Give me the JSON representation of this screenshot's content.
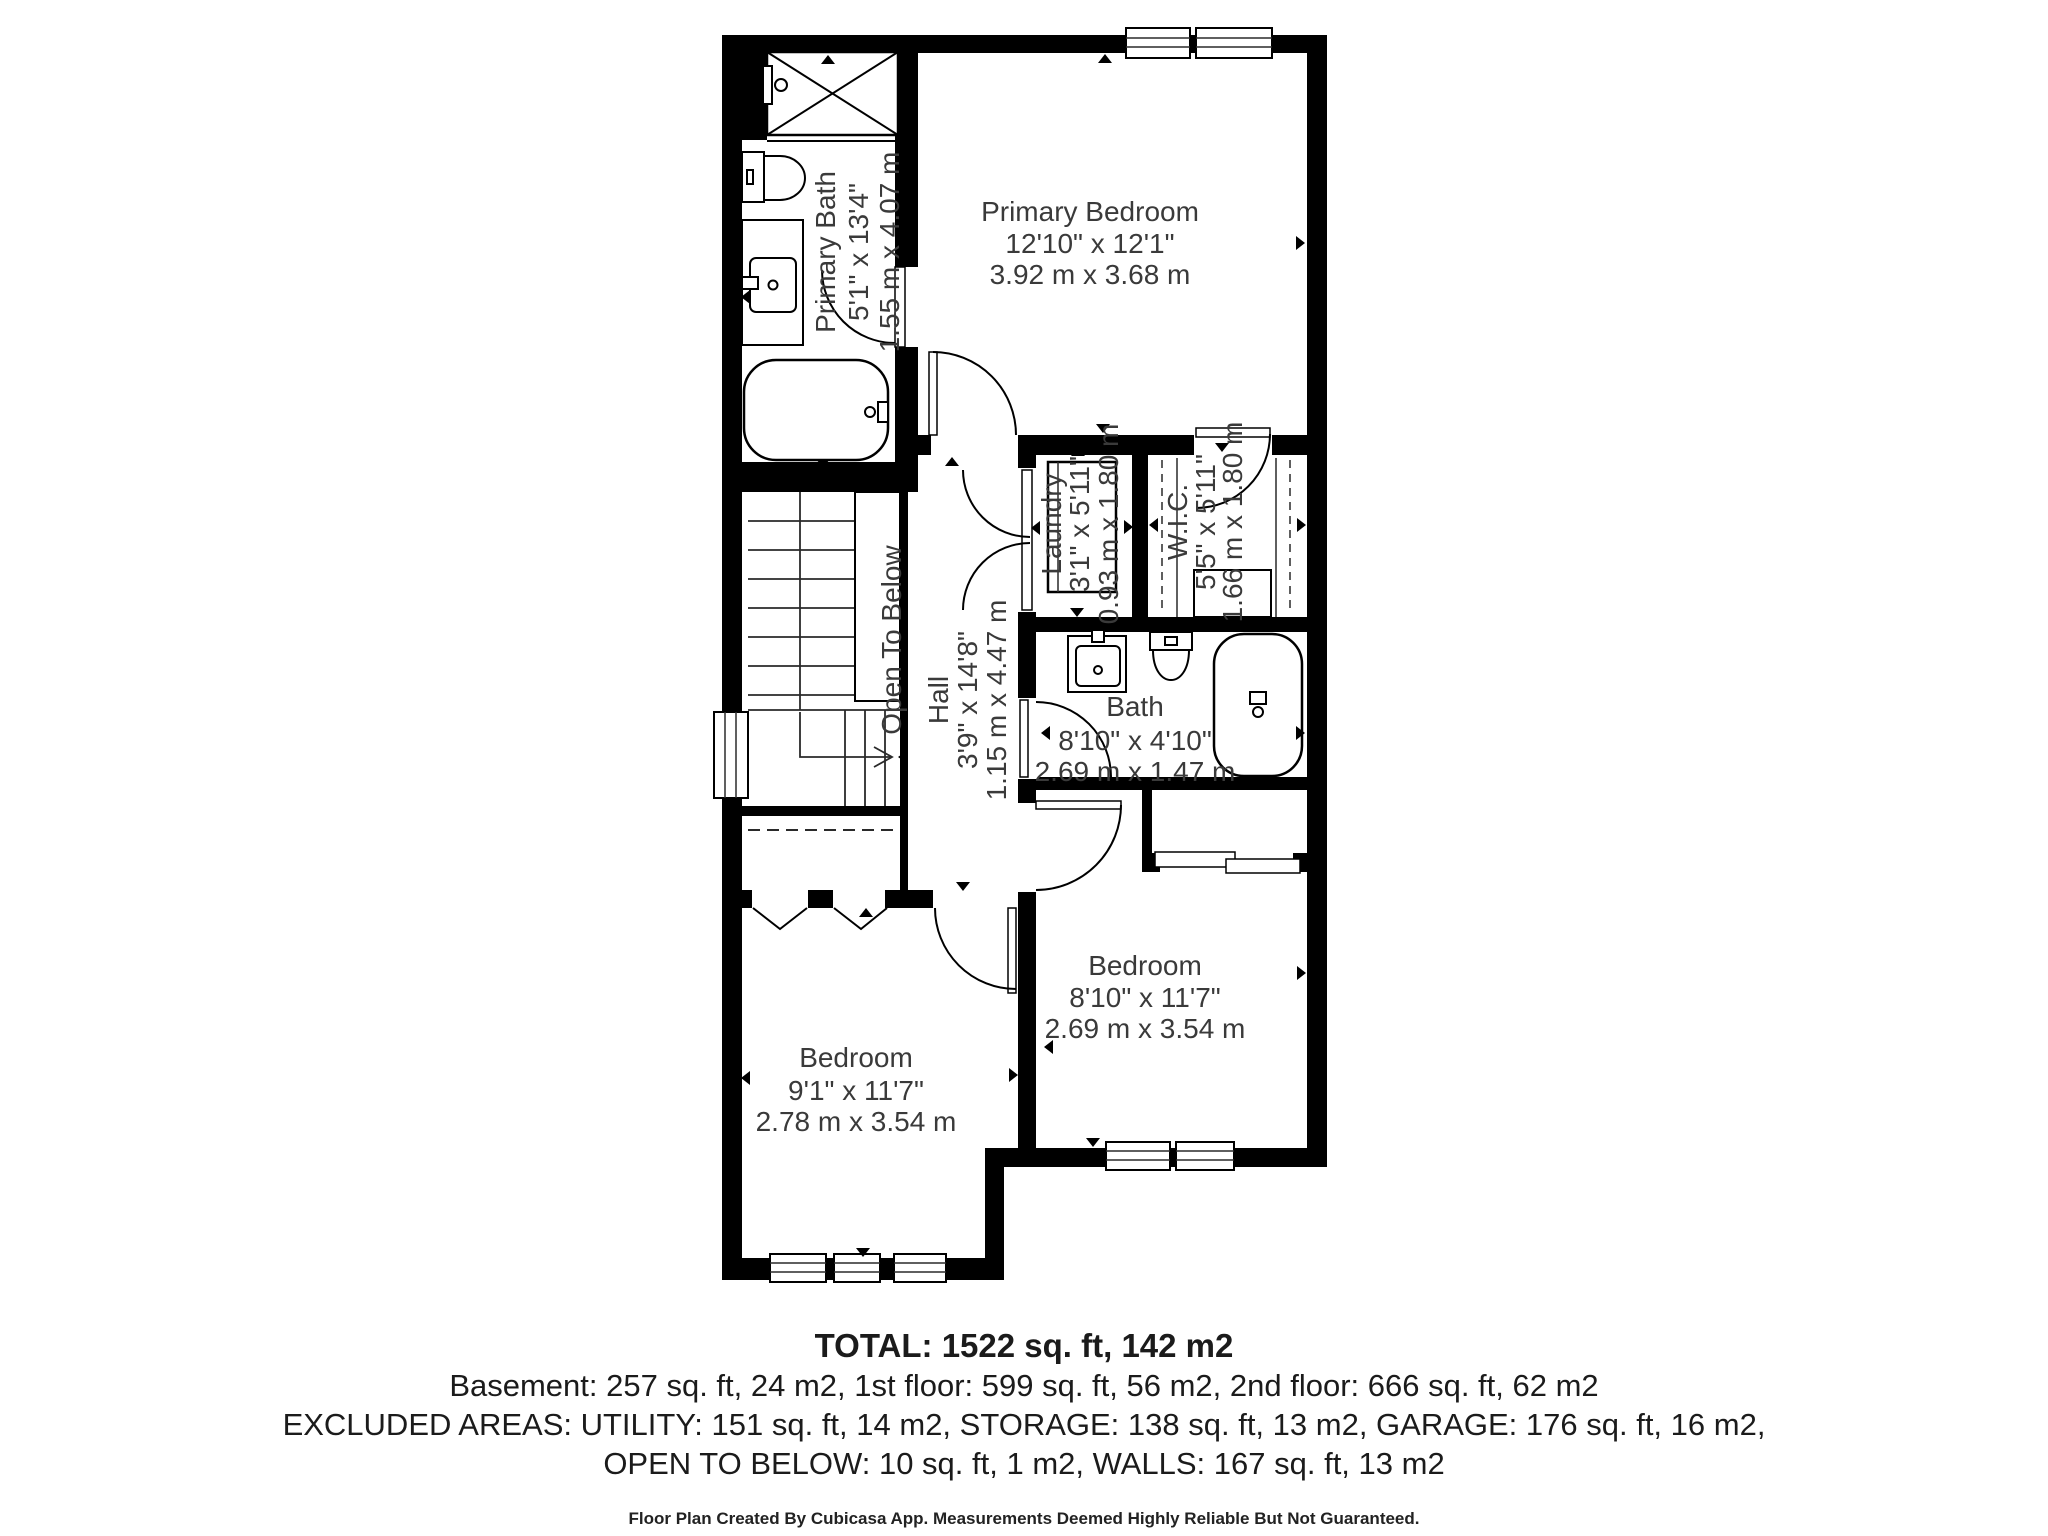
{
  "title": "2nd floor plan",
  "colors": {
    "wall": "#000000",
    "label_text": "#3a3a3a",
    "summary_text": "#1b1b1b",
    "background": "#ffffff"
  },
  "rooms": [
    {
      "name": "Primary Bedroom",
      "dim_imperial": "12'10\" x 12'1\"",
      "dim_metric": "3.92 m x 3.68 m"
    },
    {
      "name": "Primary Bath",
      "dim_imperial": "5'1\" x 13'4\"",
      "dim_metric": "1.55 m x 4.07 m"
    },
    {
      "name": "Laundry",
      "dim_imperial": "3'1\" x 5'11\"",
      "dim_metric": "0.93 m x 1.80 m"
    },
    {
      "name": "W.I.C.",
      "dim_imperial": "5'5\" x 5'11\"",
      "dim_metric": "1.66 m x 1.80 m"
    },
    {
      "name": "Hall",
      "dim_imperial": "3'9\" x 14'8\"",
      "dim_metric": "1.15 m x 4.47 m"
    },
    {
      "name": "Bath",
      "dim_imperial": "8'10\" x 4'10\"",
      "dim_metric": "2.69 m x 1.47 m"
    },
    {
      "name": "Bedroom",
      "dim_imperial": "8'10\" x 11'7\"",
      "dim_metric": "2.69 m x 3.54 m"
    },
    {
      "name": "Bedroom",
      "dim_imperial": "9'1\" x 11'7\"",
      "dim_metric": "2.78 m x 3.54 m"
    }
  ],
  "annotations": {
    "open_to_below": "Open To Below"
  },
  "summary": {
    "total": "TOTAL: 1522 sq. ft, 142 m2",
    "floors": "Basement: 257 sq. ft, 24 m2, 1st floor: 599 sq. ft, 56 m2, 2nd floor: 666 sq. ft, 62 m2",
    "excluded1": "EXCLUDED AREAS: UTILITY: 151 sq. ft, 14 m2, STORAGE: 138 sq. ft, 13 m2, GARAGE: 176 sq. ft, 16 m2,",
    "excluded2": "OPEN TO BELOW: 10 sq. ft, 1 m2, WALLS: 167 sq. ft, 13 m2",
    "footer": "Floor Plan Created By Cubicasa App. Measurements Deemed Highly Reliable But Not Guaranteed."
  }
}
